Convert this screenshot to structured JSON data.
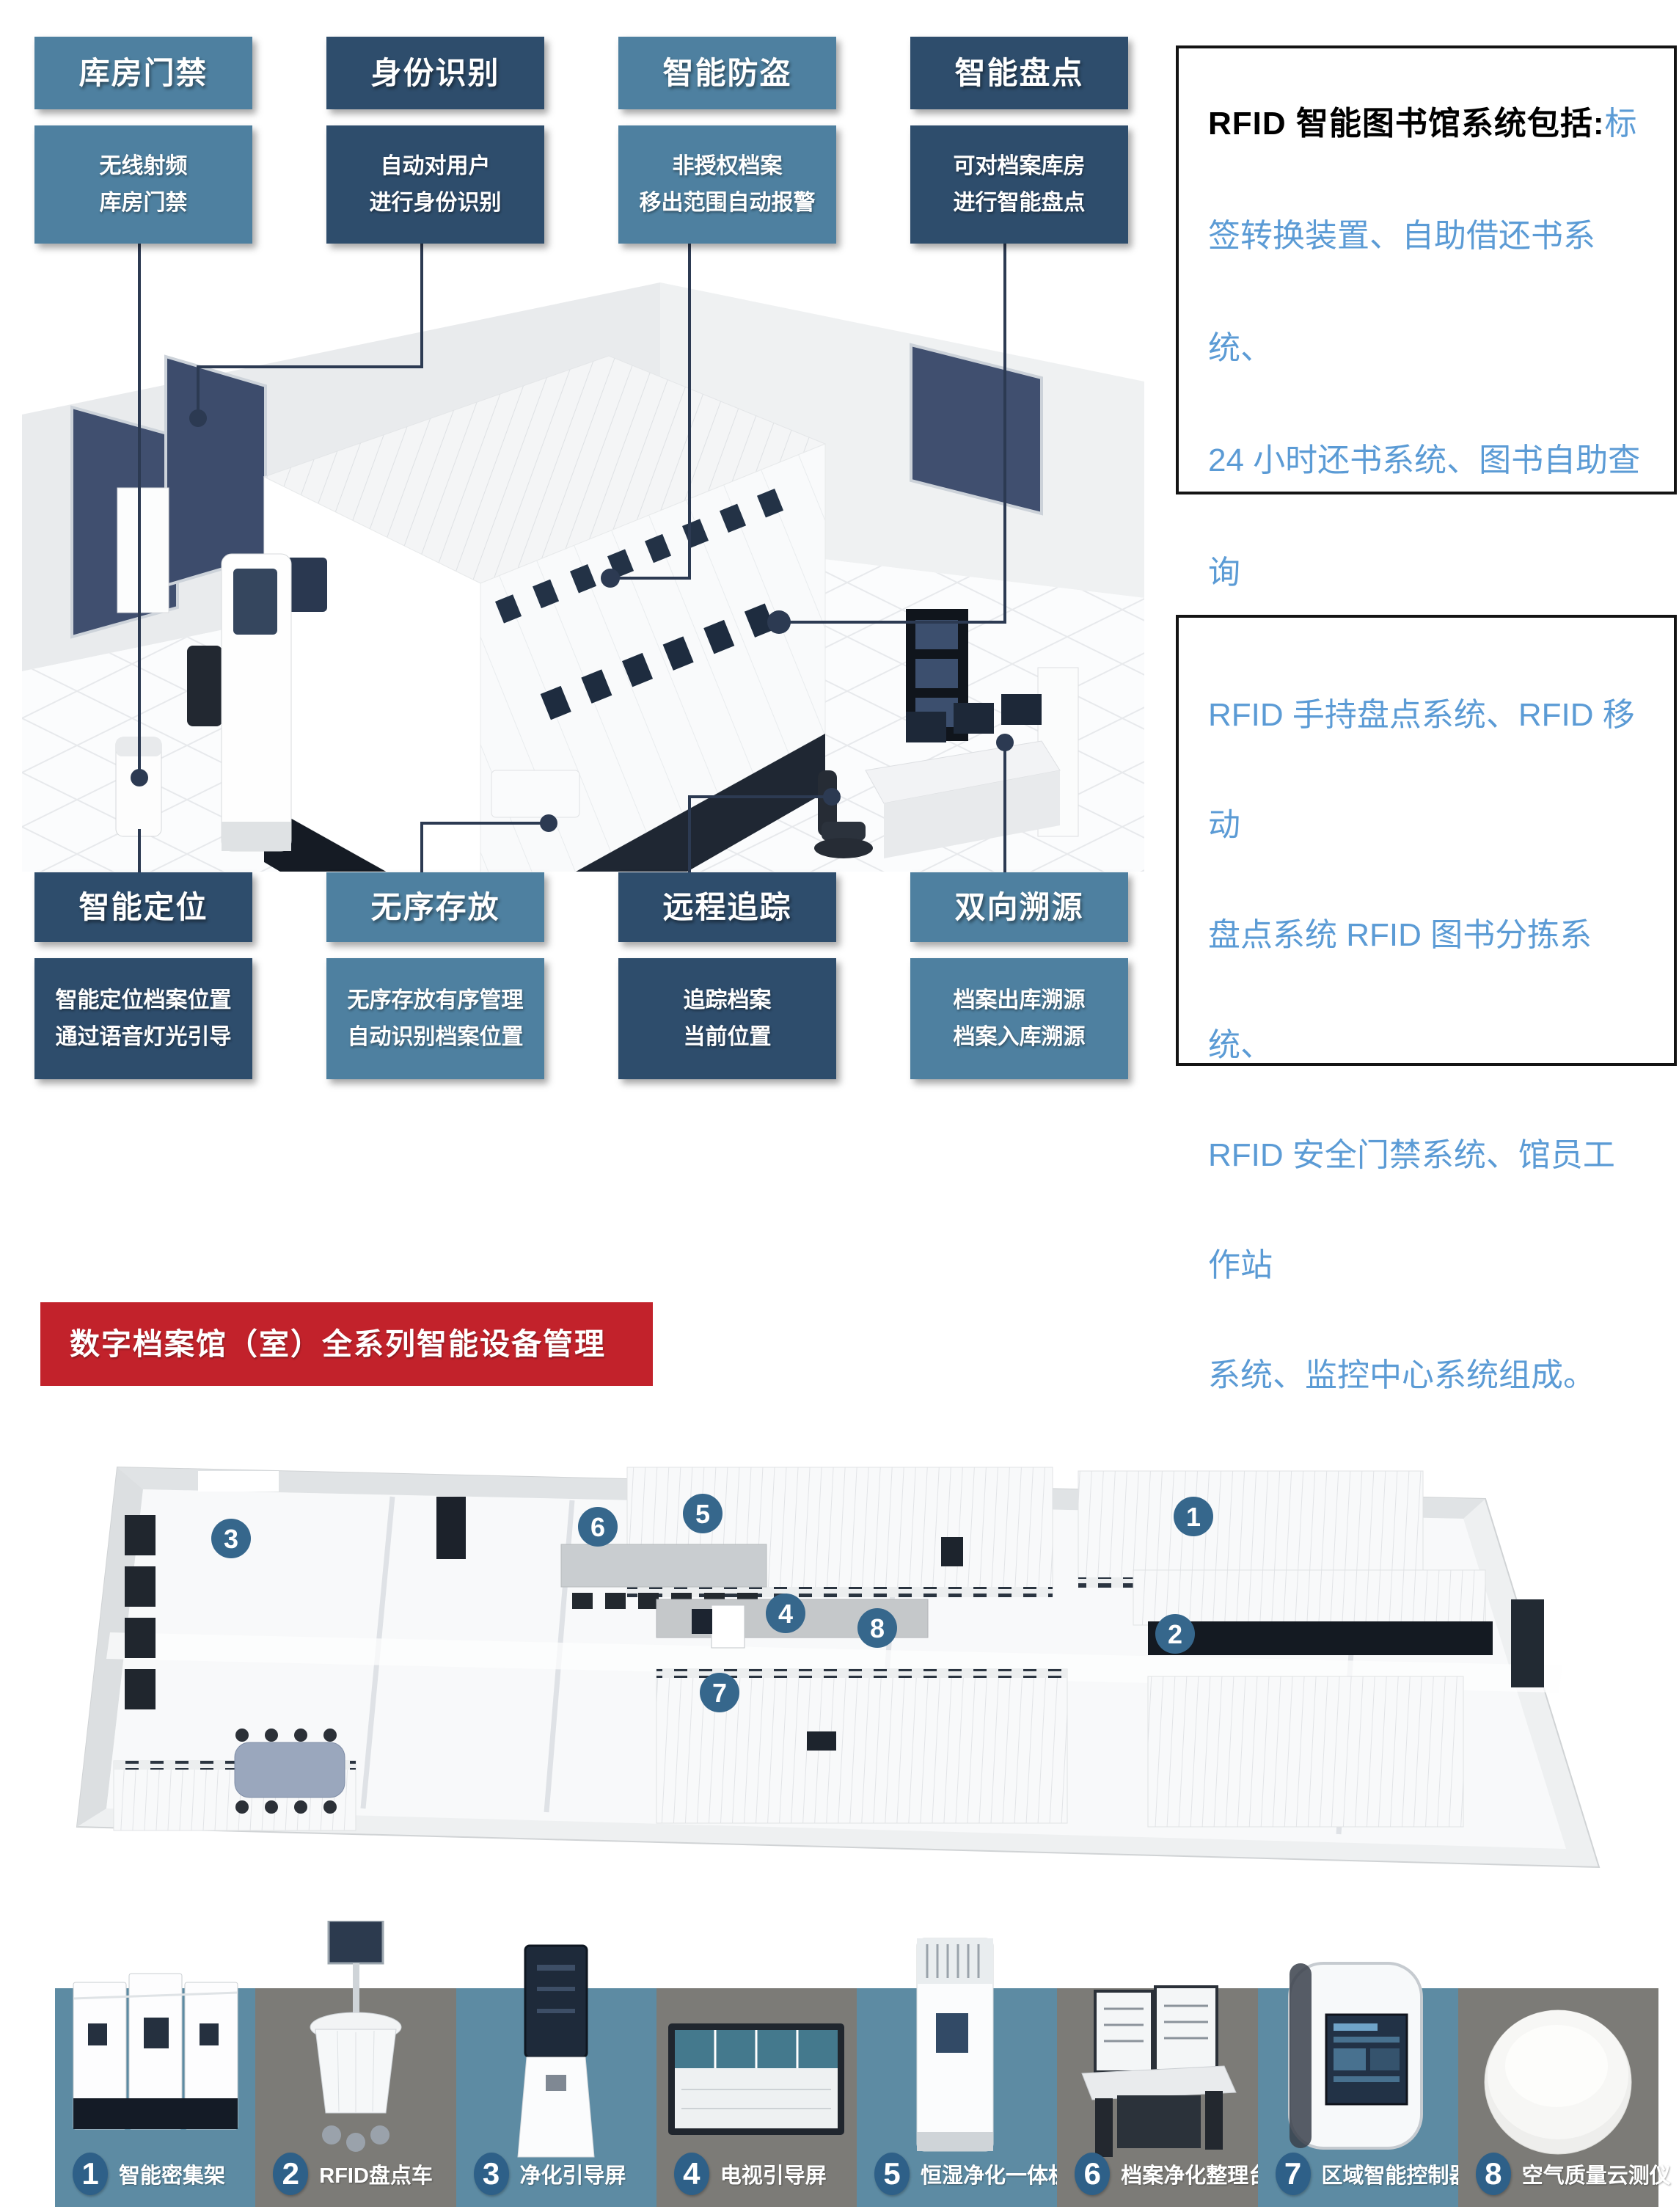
{
  "features_top": [
    {
      "title": "库房门禁",
      "desc": "无线射频\n库房门禁"
    },
    {
      "title": "身份识别",
      "desc": "自动对用户\n进行身份识别"
    },
    {
      "title": "智能防盗",
      "desc": "非授权档案\n移出范围自动报警"
    },
    {
      "title": "智能盘点",
      "desc": "可对档案库房\n进行智能盘点"
    }
  ],
  "features_bottom": [
    {
      "title": "智能定位",
      "desc": "智能定位档案位置\n通过语音灯光引导"
    },
    {
      "title": "无序存放",
      "desc": "无序存放有序管理\n自动识别档案位置"
    },
    {
      "title": "远程追踪",
      "desc": "追踪档案\n当前位置"
    },
    {
      "title": "双向溯源",
      "desc": "档案出库溯源\n档案入库溯源"
    }
  ],
  "info_panels": {
    "panel1": {
      "lead": "RFID 智能图书馆系统包括:",
      "body": "标\n签转换装置、自助借还书系统、\n24 小时还书系统、图书自助查询\n系统。"
    },
    "panel2": {
      "body": "RFID 手持盘点系统、RFID 移动\n盘点系统 RFID 图书分拣系统、\nRFID 安全门禁系统、馆员工作站\n系统、监控中心系统组成。"
    }
  },
  "banner": {
    "title": "数字档案馆（室）全系列智能设备管理"
  },
  "floorplan": {
    "markers": [
      {
        "n": "1"
      },
      {
        "n": "2"
      },
      {
        "n": "3"
      },
      {
        "n": "4"
      },
      {
        "n": "5"
      },
      {
        "n": "6"
      },
      {
        "n": "7"
      },
      {
        "n": "8"
      }
    ]
  },
  "equipment": [
    {
      "num": "1",
      "label": "智能密集架"
    },
    {
      "num": "2",
      "label": "RFID盘点车"
    },
    {
      "num": "3",
      "label": "净化引导屏"
    },
    {
      "num": "4",
      "label": "电视引导屏"
    },
    {
      "num": "5",
      "label": "恒湿净化一体机"
    },
    {
      "num": "6",
      "label": "档案净化整理台"
    },
    {
      "num": "7",
      "label": "区域智能控制器"
    },
    {
      "num": "8",
      "label": "空气质量云测仪"
    }
  ],
  "colors": {
    "accent_light": "#4e80a0",
    "accent_dark": "#2e4d6c",
    "connector": "#2c3a52",
    "blue_text": "#5b9bd5",
    "banner_red": "#c2222b",
    "strip_teal": "#5d8ba3",
    "strip_gray": "#7c7b77",
    "marker_blue": "#36678c"
  }
}
